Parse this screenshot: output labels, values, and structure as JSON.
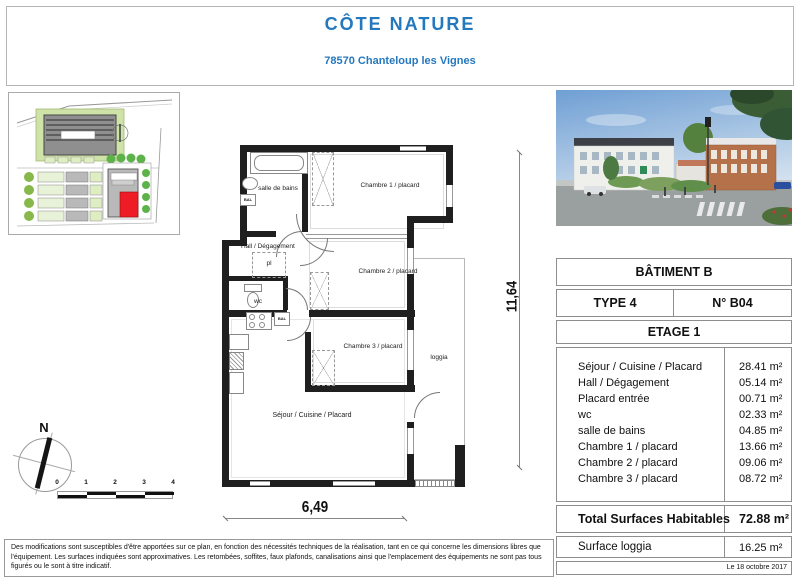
{
  "page": {
    "title": "CÔTE NATURE",
    "subtitle": "78570 Chanteloup les Vignes"
  },
  "plan": {
    "labels": {
      "bath": "salle de bains",
      "ch1": "Chambre 1 / placard",
      "hall": "Hall / Dégagement",
      "pl": "pl",
      "wc": "wc",
      "ch2": "Chambre 2 / placard",
      "ch3": "Chambre 3 / placard",
      "sejour": "Séjour / Cuisine / Placard",
      "loggia": "loggia"
    },
    "fixtures": {
      "bal": "BAL"
    },
    "north": "N",
    "dim_height": "11,64",
    "dim_width": "6,49",
    "scale": [
      "0",
      "1",
      "2",
      "3",
      "4"
    ]
  },
  "panel": {
    "batiment": "BÂTIMENT B",
    "type": "TYPE 4",
    "numero": "N° B04",
    "etage": "ETAGE 1",
    "rooms": [
      {
        "label": "Séjour / Cuisine / Placard",
        "area": "28.41 m²"
      },
      {
        "label": "Hall / Dégagement",
        "area": "05.14 m²"
      },
      {
        "label": "Placard entrée",
        "area": "00.71 m²"
      },
      {
        "label": "wc",
        "area": "02.33 m²"
      },
      {
        "label": "salle de bains",
        "area": "04.85 m²"
      },
      {
        "label": "Chambre 1 / placard",
        "area": "13.66 m²"
      },
      {
        "label": "Chambre 2 / placard",
        "area": "09.06 m²"
      },
      {
        "label": "Chambre 3 / placard",
        "area": "08.72 m²"
      }
    ],
    "total_label": "Total Surfaces Habitables",
    "total_value": "72.88 m²",
    "loggia_label": "Surface loggia",
    "loggia_value": "16.25 m²",
    "date": "Le 18 octobre 2017"
  },
  "footer": {
    "disclaimer": "Des modifications sont susceptibles d'être apportées sur ce plan, en fonction des nécessités techniques de la réalisation, tant en ce qui concerne les dimensions libres que l'équipement. Les surfaces indiquées sont approximatives. Les retombées, soffites, faux plafonds, canalisations ainsi que l'emplacement des équipements ne sont pas tous figurés ou le sont à titre indicatif."
  },
  "colors": {
    "accent": "#2478be",
    "wall": "#1f1f1f",
    "site_highlight_red": "#ee1c24"
  }
}
